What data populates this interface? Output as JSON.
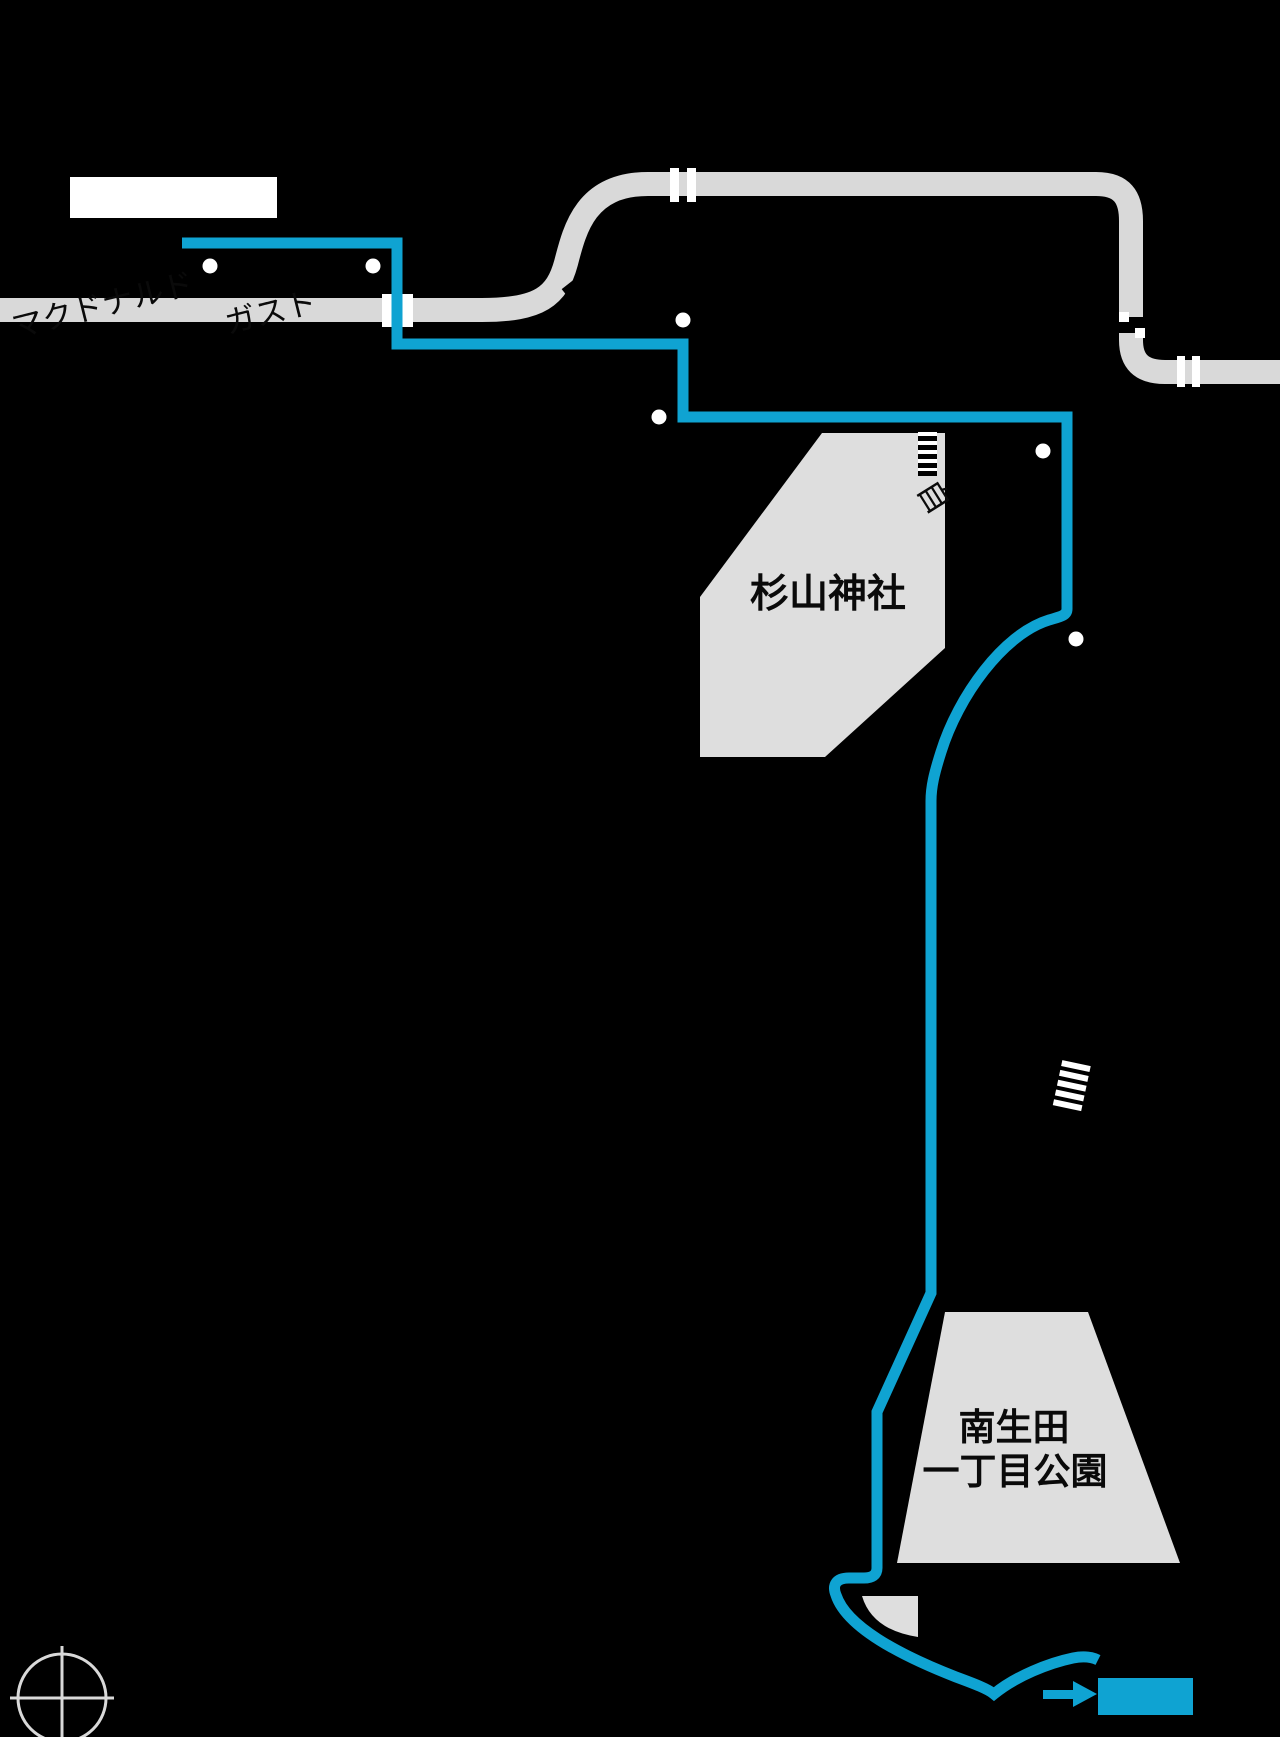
{
  "map": {
    "colors": {
      "background": "#000000",
      "route": "#0fa3d2",
      "road": "#d9d9d9",
      "area": "#dedede",
      "dot": "#ffffff",
      "label_text": "#0a0a0a",
      "label_box": "#ffffff",
      "compass": "#d9d9d9",
      "crosswalk_dark": "#000000",
      "crosswalk_light": "#ffffff"
    },
    "labels": {
      "shrine": "杉山神社",
      "park_line1": "南生田",
      "park_line2": "一丁目公園",
      "road_text_left": "マクドナルド",
      "road_text_right": "ガスト",
      "road_text_vertical": "自",
      "station_box_text": "",
      "destination_box_text": ""
    },
    "counts": {
      "waypoint_dots": 6,
      "crosswalks": 2,
      "road_boundary_bars": 2
    }
  }
}
